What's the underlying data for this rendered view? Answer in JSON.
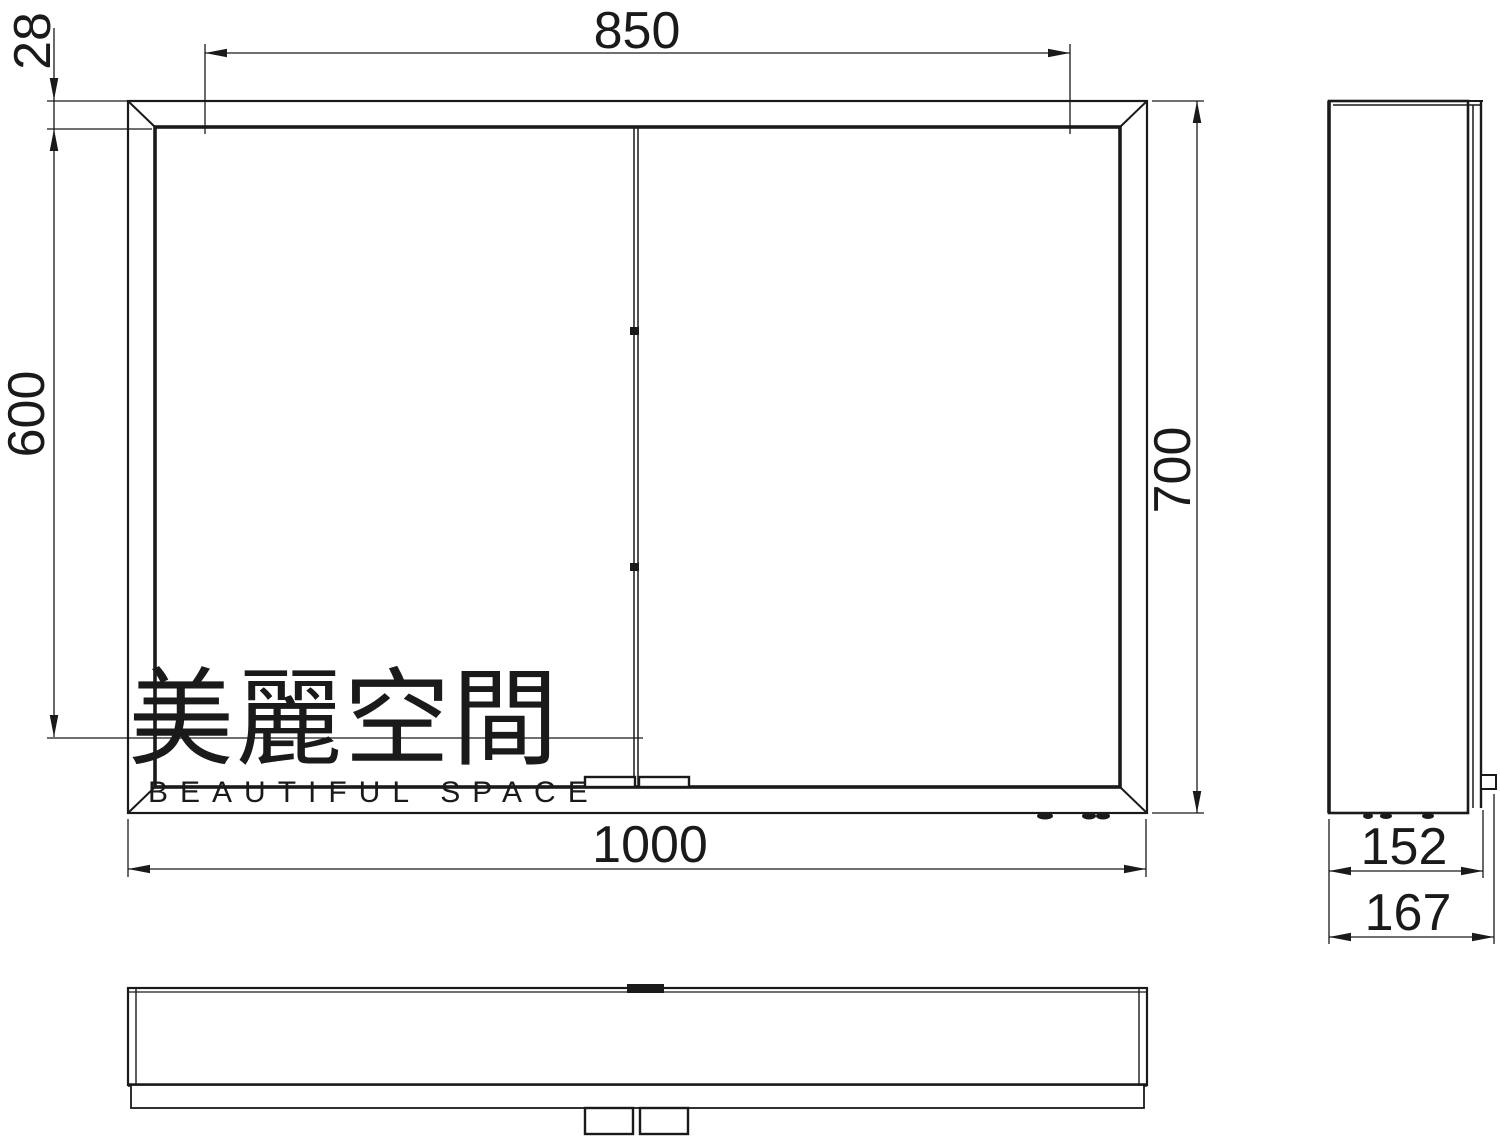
{
  "colors": {
    "line": "#1a1a1a",
    "watermark": "#d5d7f2"
  },
  "dimensions": {
    "mirror_width": "850",
    "frame_offset": "28",
    "mirror_height": "600",
    "cabinet_height": "700",
    "cabinet_width": "1000",
    "body_depth": "152",
    "total_depth": "167"
  },
  "watermark": {
    "cjk": "美麗空間",
    "latin": "BEAUTIFUL SPACE"
  }
}
